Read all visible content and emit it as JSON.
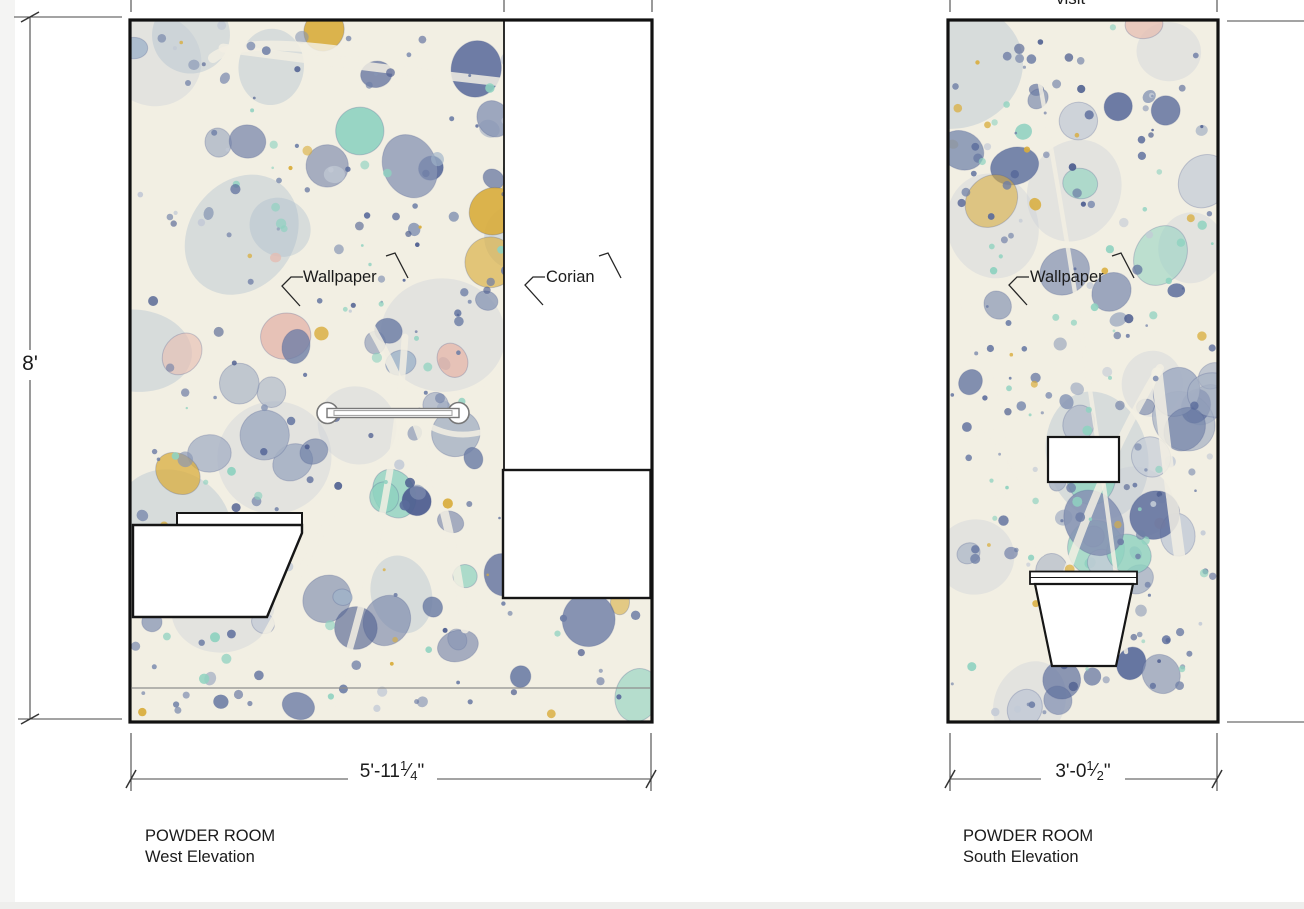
{
  "height_dimension": {
    "label": "8'"
  },
  "top_clipped_text": "visit",
  "elevations": {
    "west": {
      "title_line1": "POWDER ROOM",
      "title_line2": "West Elevation",
      "labels": {
        "wallpaper": "Wallpaper",
        "corian": "Corian"
      },
      "width_dimension": {
        "prefix": "5'-11",
        "numerator": "1",
        "slash": "⁄",
        "denominator": "4",
        "suffix": "\""
      }
    },
    "south": {
      "title_line1": "POWDER ROOM",
      "title_line2": "South Elevation",
      "labels": {
        "wallpaper": "Wallpaper"
      },
      "width_dimension": {
        "prefix": "3'-0",
        "numerator": "1",
        "slash": "⁄",
        "denominator": "2",
        "suffix": "\""
      }
    }
  },
  "colors": {
    "line": "#2b2b2b",
    "wall_border": "#111111",
    "dimension_line": "#474747",
    "fixture_fill": "#ffffff",
    "grab_bar_stroke": "#787878",
    "marble_base": "#f2efe3",
    "marble_palette": [
      "#6e7ea6",
      "#8795b4",
      "#a5b0c4",
      "#c3cad6",
      "#5a6b9b",
      "#9fb3c9",
      "#8fd2c0",
      "#d9ad3c",
      "#4f5f90",
      "#e6bdb2"
    ]
  }
}
